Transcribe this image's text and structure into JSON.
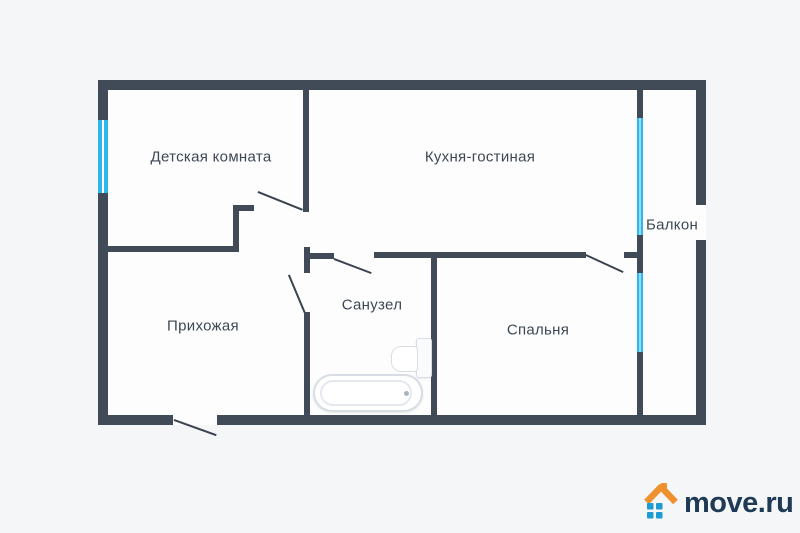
{
  "floorplan": {
    "rooms": [
      {
        "id": "detskaya",
        "label": "Детская комната"
      },
      {
        "id": "kitchen",
        "label": "Кухня-гостиная"
      },
      {
        "id": "balcony",
        "label": "Балкон"
      },
      {
        "id": "hallway",
        "label": "Прихожая"
      },
      {
        "id": "bathroom",
        "label": "Санузел"
      },
      {
        "id": "bedroom",
        "label": "Спальня"
      }
    ],
    "fixtures": [
      {
        "id": "bathtub",
        "name": "bathtub-icon"
      },
      {
        "id": "toilet",
        "name": "toilet-icon"
      }
    ],
    "colors": {
      "wall": "#414b58",
      "window": "#2eb8ea",
      "label_text": "#3d4854",
      "floor": "#fdfdfe",
      "background": "#f5f6f8"
    }
  },
  "logo": {
    "text": "move.ru",
    "icon": "house-icon",
    "colors": {
      "roof": "#f0912f",
      "windows": "#1d9cd3",
      "text": "#1e3a55"
    }
  }
}
